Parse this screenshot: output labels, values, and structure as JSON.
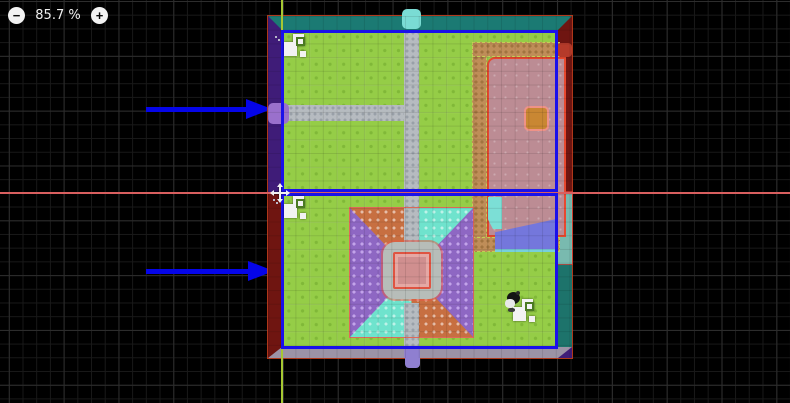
{
  "ui": {
    "zoom_controls": {
      "zoom_out_glyph": "−",
      "zoom_level": "85.7 %",
      "zoom_in_glyph": "+"
    }
  },
  "theme": {
    "bg": "#000000",
    "gridMinor": "#191919",
    "gridMajor": "#2d2d2d",
    "axisX": "#d95f5f",
    "axisY": "#a6c832",
    "selection": "#1a10ea",
    "arrow": "#0505e8",
    "stripTop": "#1b7a73",
    "stripPurple": "#3f1c78",
    "stripRed": "#6f1511",
    "stripTealDark": "#1d736b",
    "stripTealLight": "#79baaf",
    "stripBottom": "#9c93a6",
    "grass": "#95cd47",
    "grassDot": "#80b838",
    "path": "#b6bbc0",
    "pathDot": "#99a0a8",
    "tanPath": "#bf8d58",
    "tanDot": "#a1743f",
    "pinkZone": "#bc8c94",
    "pinkBorder": "#e8492f",
    "orangeBlob": "#c98733",
    "lake": "#7477dc",
    "waterfall": "#7cdfd6",
    "flowerOrange": "#c76f41",
    "flowerCyan": "#6fe3cd",
    "flowerPurple": "#8e67c3",
    "ringGray": "#b7bdb9",
    "centerPink": "#d08f8f",
    "centerBorder": "#df5442",
    "blobPurple": "#9a70cc",
    "blobCyan": "#7adcd4",
    "blobRed": "#b53a2a"
  },
  "icons": {
    "zoom_out": "minus-circle",
    "zoom_in": "plus-circle",
    "chunk_marker": "stamp-chunk-icon",
    "origin_marker": "move-crosshair-icon",
    "arrow_annotation": "blue-right-arrow"
  },
  "map": {
    "regions": [
      {
        "name": "upper-selected-region"
      },
      {
        "name": "lower-selected-region"
      }
    ]
  }
}
